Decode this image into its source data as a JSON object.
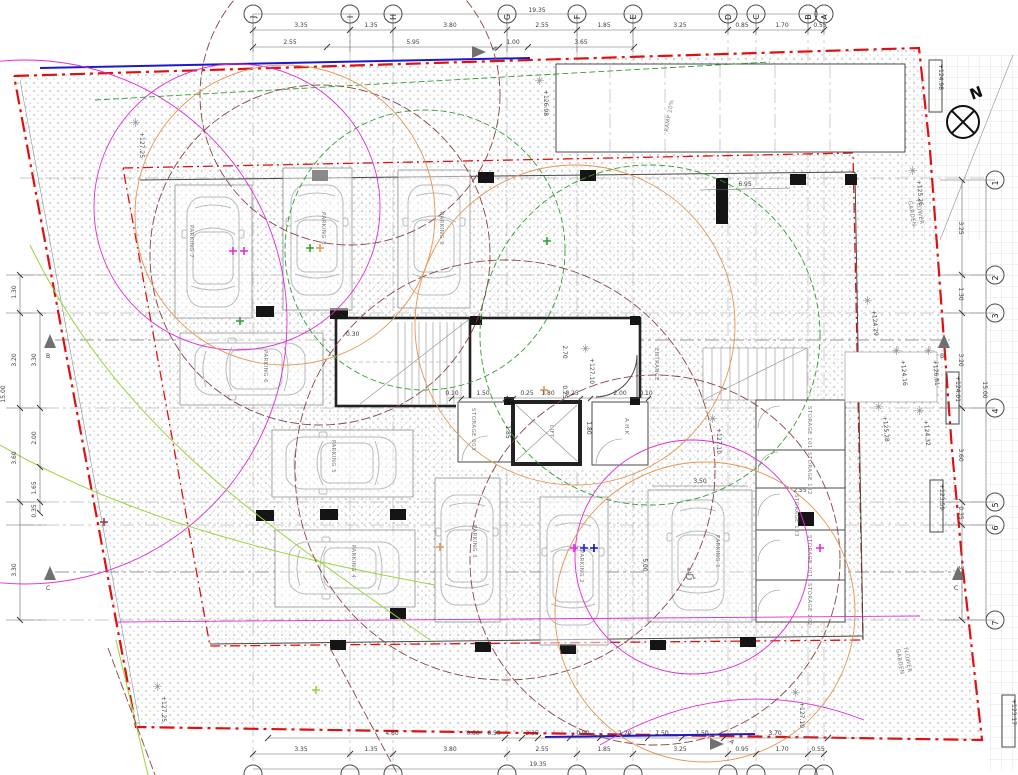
{
  "title": "Basement parking floor plan",
  "north": "N",
  "grid": {
    "top": [
      "J",
      "I",
      "H",
      "G",
      "F",
      "E",
      "D",
      "C",
      "B",
      "A"
    ],
    "right": [
      "1",
      "2",
      "3",
      "4",
      "5",
      "6",
      "7"
    ]
  },
  "sections": {
    "a": "A",
    "b": "B",
    "c": "C"
  },
  "dims": {
    "top1": [
      "3.35",
      "1.35",
      "3.80",
      "2.55",
      "1.85",
      "3.25",
      "0.85",
      "1.70",
      "0.55"
    ],
    "top2": [
      "2.55",
      "5.95",
      "1.00",
      "3.65"
    ],
    "top_total": "19.35",
    "bot1": [
      "4.60",
      "0.60",
      "0.50",
      "2.35",
      "0.90",
      "1.20",
      "1.50",
      "1.50",
      "3.70"
    ],
    "bot2": [
      "3.35",
      "1.35",
      "3.80",
      "2.55",
      "1.85",
      "3.25",
      "0.95",
      "1.70",
      "0.55"
    ],
    "bot_total": "19.35",
    "right": [
      "3.25",
      "1.30",
      "3.20",
      "3.60",
      "0.35",
      "3.30"
    ],
    "right_total": "15.00",
    "left": [
      "1.30",
      "3.20",
      "3.60",
      "3.30"
    ],
    "left_inner": [
      "3.30",
      "2.00",
      "1.65",
      "0.35"
    ],
    "left_total": "15.00",
    "core_row": [
      "0.10",
      "1.50",
      "0.25",
      "1.80",
      "0.25",
      "2.00",
      "0.10"
    ],
    "v_270": "2.70",
    "v_025": "0.25",
    "v_185": "1.85",
    "v_180": "1.80",
    "v_030": "0.30",
    "p1_w": "3.50",
    "p1_l": "5.00",
    "st_w": "2.55",
    "hall": "6.95"
  },
  "labels": {
    "parking": [
      "PARKING 1",
      "PARKING 2",
      "PARKING 3",
      "PARKING 4",
      "PARKING 5",
      "PARKING 6",
      "PARKING 7",
      "PARKING 8",
      "PARKING 9"
    ],
    "storage": [
      "STORAGE 101",
      "STORAGE 102",
      "STORAGE 103",
      "STORAGE 201",
      "STORAGE 202"
    ],
    "storage_core": "STORAGE 003",
    "lift": "LIFT",
    "ahk": "A.H.K",
    "entrance": "ENTRANCE",
    "ramp": "RAMP 20%",
    "flower1": "FLOWER",
    "flower2": "GARDEN"
  },
  "levels": {
    "box_ne": "+124.98",
    "box_e": "+124.01",
    "box_se": "+123.59",
    "box_br": "+123.17",
    "nw": "+127.25",
    "ramp": "+126.98",
    "hall": "+127.10",
    "p1": "+127.10",
    "sw": "+127.25",
    "s_col": "+127.10",
    "fg_ne": "+125.26",
    "fg_e1": "+124.29",
    "fg_e2": "+126.81",
    "fg_e3": "+124.16",
    "fg_e4": "+125.28",
    "fg_e5": "+124.32"
  },
  "colors": {
    "boundary": "#e01010",
    "magenta": "#e02ad8",
    "green": "#2f9e2f",
    "lightgreen": "#97d63c",
    "brown": "#8a4343",
    "orange": "#e6954f",
    "blue": "#1a1acc"
  }
}
